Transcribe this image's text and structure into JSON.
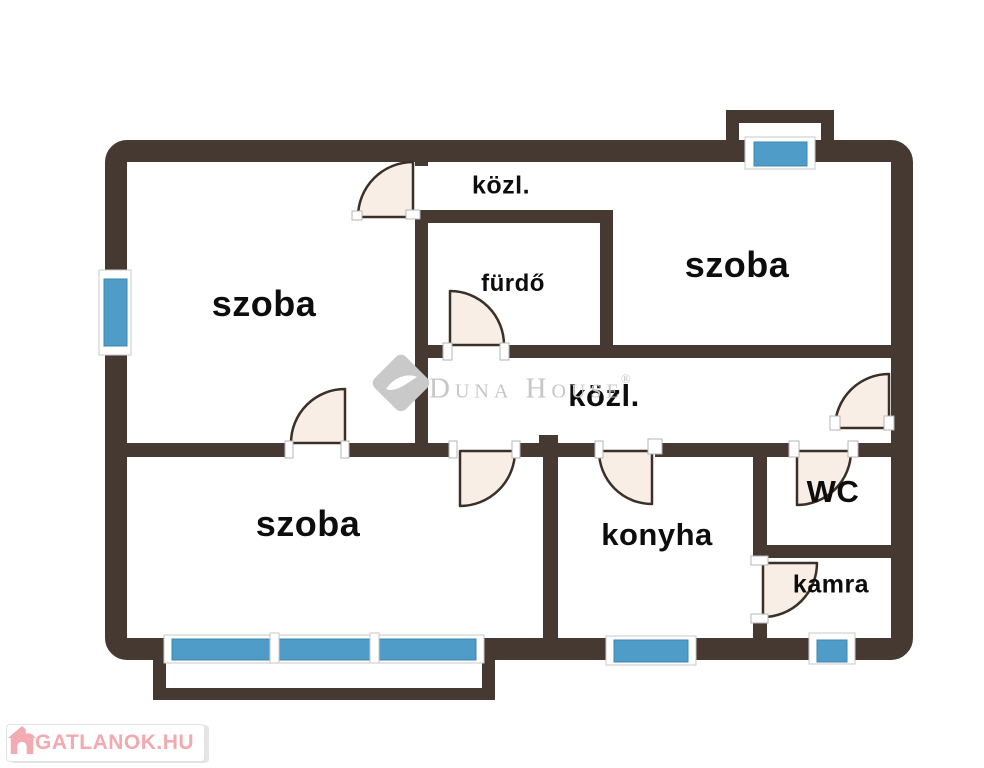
{
  "floorplan": {
    "rooms": [
      {
        "id": "szoba-top-left",
        "label": "szoba"
      },
      {
        "id": "kozl-top",
        "label": "közl."
      },
      {
        "id": "furdo",
        "label": "fürdő"
      },
      {
        "id": "szoba-top-right",
        "label": "szoba"
      },
      {
        "id": "kozl-middle",
        "label": "közl."
      },
      {
        "id": "szoba-bottom-left",
        "label": "szoba"
      },
      {
        "id": "konyha",
        "label": "konyha"
      },
      {
        "id": "wc",
        "label": "WC"
      },
      {
        "id": "kamra",
        "label": "kamra"
      }
    ],
    "watermark": {
      "brand": "Duna House",
      "registered": "®"
    },
    "provider": {
      "name": "INGATLANOK.HU"
    },
    "colors": {
      "wall": "#463931",
      "window_blue": "#4f9cc8",
      "door_fill": "#f8eee5",
      "watermark_gray": "#c7c7c7",
      "provider_pink": "#f2a9b0"
    }
  }
}
